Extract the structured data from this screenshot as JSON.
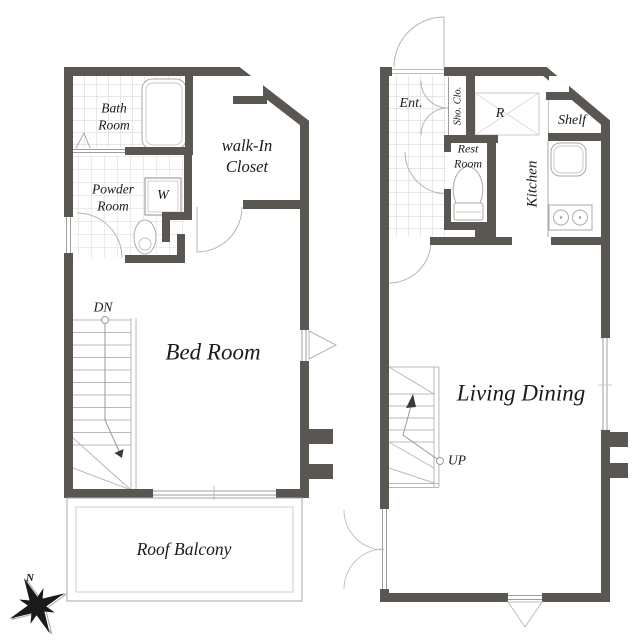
{
  "colors": {
    "wall": "#5a5652",
    "fixture_line": "#a9a9a9",
    "tile_line": "#d6d6d6",
    "text": "#1b1b1b"
  },
  "floor2": {
    "bath_room": [
      "Bath",
      "Room"
    ],
    "powder_room": [
      "Powder",
      "Room"
    ],
    "walk_in_closet": [
      "walk-In",
      "Closet"
    ],
    "washer": "W",
    "down": "DN",
    "bed_room": "Bed Room",
    "roof_balcony": "Roof Balcony"
  },
  "floor1": {
    "entrance": "Ent.",
    "shoe_closet": "Sho. Clo.",
    "refrigerator": "R",
    "shelf": "Shelf",
    "kitchen": "Kitchen",
    "rest_room": [
      "Rest",
      "Room"
    ],
    "living_dining": "Living Dining",
    "up": "UP"
  },
  "compass": {
    "north": "N"
  }
}
